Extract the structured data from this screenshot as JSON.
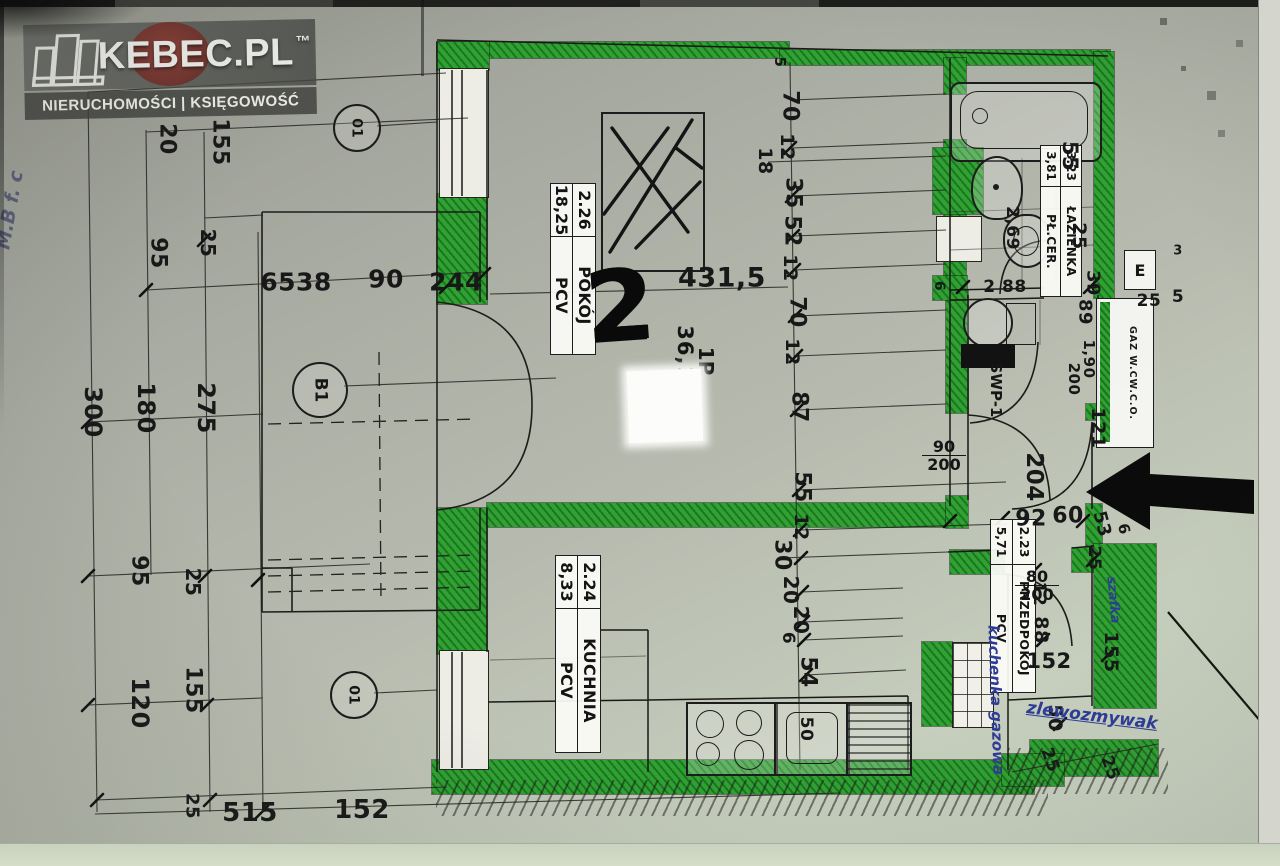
{
  "watermark": {
    "brand": "KEBEC.PL",
    "tm": "™",
    "tagline": "NIERUCHOMOŚCI | KSIĘGOWOŚĆ"
  },
  "plan": {
    "unit": {
      "number": "2",
      "name": "1P",
      "area": "36,10"
    },
    "rooms": [
      {
        "id": "2.26",
        "name": "POKÓJ",
        "area": "18,25",
        "floor": "PCV"
      },
      {
        "id": "3.23",
        "name": "ŁAZIENKA",
        "area": "3,81",
        "floor": "PŁ.CER."
      },
      {
        "id": "2.23",
        "name": "PRZEDPOKÓJ",
        "area": "5,71",
        "floor": "PCV"
      },
      {
        "id": "2.24",
        "name": "KUCHNIA",
        "area": "8,33",
        "floor": "PCV"
      }
    ],
    "doors": {
      "room": {
        "w": "90",
        "h": "200"
      },
      "kitchen": {
        "w": "80",
        "h": "200"
      }
    },
    "markers": {
      "balcony": "B1",
      "window": "01",
      "swp": "SWP-1",
      "meter": "E",
      "shaft": "GAZ W.CW.C.O."
    },
    "handwritten": {
      "stove": "kuchenka gazowa",
      "sink": "zlewozmywak",
      "cabinet": "szafka",
      "margin": "M.B f. c"
    },
    "colors": {
      "wall_highlight": "#2fa233",
      "ink": "#181818",
      "pen": "#2e3c96"
    }
  },
  "dims": {
    "all": [
      {
        "t": "155",
        "x": 220,
        "y": 142
      },
      {
        "t": "20",
        "x": 167,
        "y": 139
      },
      {
        "t": "25",
        "x": 208,
        "y": 243,
        "s": 20
      },
      {
        "t": "95",
        "x": 158,
        "y": 253
      },
      {
        "t": "300",
        "x": 93,
        "y": 412,
        "s": 24
      },
      {
        "t": "180",
        "x": 146,
        "y": 408,
        "s": 24
      },
      {
        "t": "275",
        "x": 206,
        "y": 408,
        "s": 24
      },
      {
        "t": "95",
        "x": 139,
        "y": 571
      },
      {
        "t": "25",
        "x": 193,
        "y": 582,
        "s": 20
      },
      {
        "t": "120",
        "x": 140,
        "y": 703,
        "s": 24
      },
      {
        "t": "155",
        "x": 193,
        "y": 690
      },
      {
        "t": "25",
        "x": 192,
        "y": 806,
        "s": 18
      },
      {
        "t": "515",
        "x": 250,
        "y": 813,
        "r": 0,
        "s": 26
      },
      {
        "t": "152",
        "x": 362,
        "y": 810,
        "r": 0,
        "s": 26
      },
      {
        "t": "6538",
        "x": 296,
        "y": 282,
        "r": 0,
        "s": 25
      },
      {
        "t": "90",
        "x": 386,
        "y": 279,
        "r": 0,
        "s": 25
      },
      {
        "t": "244",
        "x": 456,
        "y": 282,
        "r": 0,
        "s": 25
      },
      {
        "t": "5",
        "x": 780,
        "y": 62,
        "s": 15
      },
      {
        "t": "70",
        "x": 790,
        "y": 106
      },
      {
        "t": "12",
        "x": 787,
        "y": 147,
        "s": 19
      },
      {
        "t": "18",
        "x": 765,
        "y": 161,
        "s": 19
      },
      {
        "t": "35",
        "x": 793,
        "y": 193
      },
      {
        "t": "52",
        "x": 792,
        "y": 231
      },
      {
        "t": "12",
        "x": 790,
        "y": 268,
        "s": 19
      },
      {
        "t": "70",
        "x": 797,
        "y": 312
      },
      {
        "t": "12",
        "x": 792,
        "y": 352,
        "s": 19
      },
      {
        "t": "87",
        "x": 799,
        "y": 407
      },
      {
        "t": "55",
        "x": 802,
        "y": 487
      },
      {
        "t": "12",
        "x": 801,
        "y": 527,
        "s": 19
      },
      {
        "t": "30",
        "x": 782,
        "y": 555
      },
      {
        "t": "20",
        "x": 791,
        "y": 590,
        "s": 20
      },
      {
        "t": "20",
        "x": 801,
        "y": 620,
        "s": 20
      },
      {
        "t": "6",
        "x": 788,
        "y": 638,
        "s": 17
      },
      {
        "t": "54",
        "x": 808,
        "y": 672
      },
      {
        "t": "431,5",
        "x": 722,
        "y": 278,
        "r": 0,
        "s": 27
      },
      {
        "t": "2 88",
        "x": 1005,
        "y": 287,
        "r": 0,
        "s": 17
      },
      {
        "t": "55",
        "x": 1070,
        "y": 156,
        "s": 21
      },
      {
        "t": "25",
        "x": 1079,
        "y": 236,
        "s": 19
      },
      {
        "t": "2,69",
        "x": 1012,
        "y": 228,
        "s": 17
      },
      {
        "t": "6",
        "x": 939,
        "y": 286,
        "s": 14
      },
      {
        "t": "39",
        "x": 1093,
        "y": 283,
        "s": 18
      },
      {
        "t": "89",
        "x": 1085,
        "y": 312,
        "s": 18
      },
      {
        "t": "3",
        "x": 1178,
        "y": 251,
        "r": 0,
        "s": 13
      },
      {
        "t": "25",
        "x": 1149,
        "y": 301,
        "r": 0,
        "s": 17
      },
      {
        "t": "5",
        "x": 1178,
        "y": 297,
        "r": 0,
        "s": 17
      },
      {
        "t": "1,90",
        "x": 1089,
        "y": 359,
        "s": 15
      },
      {
        "t": "200",
        "x": 1074,
        "y": 379,
        "s": 15
      },
      {
        "t": "121",
        "x": 1098,
        "y": 428,
        "s": 19
      },
      {
        "t": "204",
        "x": 1034,
        "y": 477,
        "s": 23
      },
      {
        "t": "92",
        "x": 1031,
        "y": 519,
        "r": 0,
        "s": 22
      },
      {
        "t": "60",
        "x": 1068,
        "y": 516,
        "r": 0,
        "s": 22
      },
      {
        "t": "53",
        "x": 1102,
        "y": 524,
        "r": 75,
        "s": 18
      },
      {
        "t": "6",
        "x": 1124,
        "y": 529,
        "r": 75,
        "s": 15
      },
      {
        "t": "25",
        "x": 1094,
        "y": 558,
        "s": 17
      },
      {
        "t": "12",
        "x": 1039,
        "y": 594,
        "s": 17
      },
      {
        "t": "88",
        "x": 1041,
        "y": 630,
        "s": 19
      },
      {
        "t": "152",
        "x": 1049,
        "y": 661,
        "r": 0,
        "s": 21
      },
      {
        "t": "155",
        "x": 1111,
        "y": 652,
        "s": 19
      },
      {
        "t": "50",
        "x": 1055,
        "y": 718,
        "s": 19
      },
      {
        "t": "25",
        "x": 1050,
        "y": 760,
        "r": 70,
        "s": 17
      },
      {
        "t": "25",
        "x": 1110,
        "y": 768,
        "r": 70,
        "s": 17
      },
      {
        "t": "50",
        "x": 806,
        "y": 729,
        "s": 17
      }
    ]
  }
}
